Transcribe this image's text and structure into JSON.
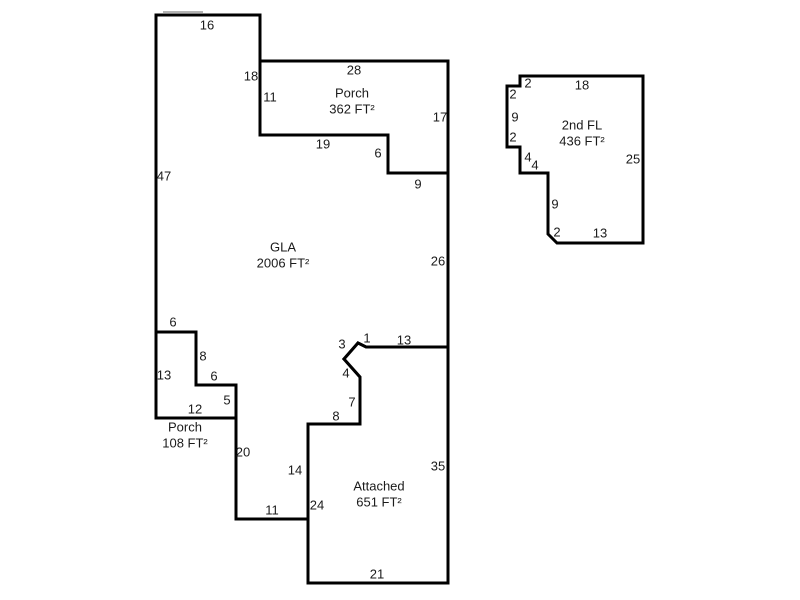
{
  "canvas": {
    "width": 800,
    "height": 600,
    "background": "#ffffff",
    "wall_color": "#000000",
    "wall_width": 3,
    "text_color": "#1b1b1b",
    "font_size": 13,
    "label_line_height": 16
  },
  "floorplan": {
    "units": "FT²",
    "areas": [
      {
        "id": "gla",
        "area_sqft": 2006,
        "label": {
          "lines": [
            "GLA",
            "2006 FT²"
          ],
          "x": 283,
          "y": 247
        },
        "points": [
          [
            156,
            15
          ],
          [
            260,
            15
          ],
          [
            260,
            135
          ],
          [
            388,
            135
          ],
          [
            388,
            173
          ],
          [
            448,
            173
          ],
          [
            448,
            347
          ],
          [
            366,
            347
          ],
          [
            358,
            343
          ],
          [
            344,
            359
          ],
          [
            360,
            377
          ],
          [
            360,
            424
          ],
          [
            308,
            424
          ],
          [
            308,
            519
          ],
          [
            236,
            519
          ],
          [
            236,
            385
          ],
          [
            196,
            385
          ],
          [
            196,
            332
          ],
          [
            156,
            332
          ]
        ]
      },
      {
        "id": "porch-upper",
        "area_sqft": 362,
        "label": {
          "lines": [
            "Porch",
            "362 FT²"
          ],
          "x": 352,
          "y": 93
        },
        "points": [
          [
            260,
            61
          ],
          [
            448,
            61
          ],
          [
            448,
            173
          ],
          [
            388,
            173
          ],
          [
            388,
            135
          ],
          [
            260,
            135
          ]
        ]
      },
      {
        "id": "porch-lower",
        "area_sqft": 108,
        "label": {
          "lines": [
            "Porch",
            "108 FT²"
          ],
          "x": 185,
          "y": 427
        },
        "points": [
          [
            156,
            332
          ],
          [
            196,
            332
          ],
          [
            196,
            385
          ],
          [
            236,
            385
          ],
          [
            236,
            418
          ],
          [
            156,
            418
          ]
        ]
      },
      {
        "id": "attached-garage",
        "area_sqft": 651,
        "label": {
          "lines": [
            "Attached",
            "651 FT²"
          ],
          "x": 379,
          "y": 486
        },
        "points": [
          [
            308,
            424
          ],
          [
            360,
            424
          ],
          [
            360,
            377
          ],
          [
            344,
            359
          ],
          [
            358,
            343
          ],
          [
            366,
            347
          ],
          [
            448,
            347
          ],
          [
            448,
            583
          ],
          [
            308,
            583
          ]
        ]
      },
      {
        "id": "second-floor",
        "area_sqft": 436,
        "label": {
          "lines": [
            "2nd FL",
            "436 FT²"
          ],
          "x": 582,
          "y": 125
        },
        "points": [
          [
            520,
            76
          ],
          [
            643,
            76
          ],
          [
            643,
            243
          ],
          [
            557,
            243
          ],
          [
            548,
            234
          ],
          [
            548,
            173
          ],
          [
            520,
            173
          ],
          [
            520,
            147
          ],
          [
            507,
            147
          ],
          [
            507,
            86
          ],
          [
            520,
            86
          ]
        ]
      }
    ],
    "dimensions": [
      {
        "text": "16",
        "x": 207,
        "y": 25
      },
      {
        "text": "18",
        "x": 251,
        "y": 76
      },
      {
        "text": "11",
        "x": 270,
        "y": 97
      },
      {
        "text": "28",
        "x": 354,
        "y": 70
      },
      {
        "text": "17",
        "x": 440,
        "y": 117
      },
      {
        "text": "19",
        "x": 323,
        "y": 144
      },
      {
        "text": "6",
        "x": 378,
        "y": 153
      },
      {
        "text": "9",
        "x": 418,
        "y": 184
      },
      {
        "text": "47",
        "x": 164,
        "y": 176
      },
      {
        "text": "26",
        "x": 438,
        "y": 261
      },
      {
        "text": "6",
        "x": 173,
        "y": 322
      },
      {
        "text": "8",
        "x": 203,
        "y": 356
      },
      {
        "text": "13",
        "x": 164,
        "y": 375
      },
      {
        "text": "6",
        "x": 214,
        "y": 376
      },
      {
        "text": "5",
        "x": 227,
        "y": 400
      },
      {
        "text": "12",
        "x": 195,
        "y": 409
      },
      {
        "text": "20",
        "x": 243,
        "y": 452
      },
      {
        "text": "14",
        "x": 295,
        "y": 470
      },
      {
        "text": "11",
        "x": 272,
        "y": 510
      },
      {
        "text": "24",
        "x": 317,
        "y": 505
      },
      {
        "text": "8",
        "x": 336,
        "y": 416
      },
      {
        "text": "7",
        "x": 352,
        "y": 402
      },
      {
        "text": "4",
        "x": 346,
        "y": 373
      },
      {
        "text": "3",
        "x": 342,
        "y": 344
      },
      {
        "text": "1",
        "x": 367,
        "y": 338
      },
      {
        "text": "13",
        "x": 404,
        "y": 340
      },
      {
        "text": "35",
        "x": 438,
        "y": 466
      },
      {
        "text": "21",
        "x": 377,
        "y": 574
      },
      {
        "text": "2",
        "x": 528,
        "y": 83
      },
      {
        "text": "18",
        "x": 582,
        "y": 85
      },
      {
        "text": "2",
        "x": 513,
        "y": 94
      },
      {
        "text": "9",
        "x": 515,
        "y": 117
      },
      {
        "text": "2",
        "x": 513,
        "y": 137
      },
      {
        "text": "4",
        "x": 528,
        "y": 157
      },
      {
        "text": "4",
        "x": 535,
        "y": 165
      },
      {
        "text": "9",
        "x": 555,
        "y": 204
      },
      {
        "text": "2",
        "x": 557,
        "y": 232
      },
      {
        "text": "13",
        "x": 600,
        "y": 233
      },
      {
        "text": "25",
        "x": 633,
        "y": 159
      }
    ],
    "artifact": {
      "x1": 163,
      "y1": 12,
      "x2": 203,
      "y2": 12,
      "color": "#b3b3b3",
      "width": 2
    }
  }
}
